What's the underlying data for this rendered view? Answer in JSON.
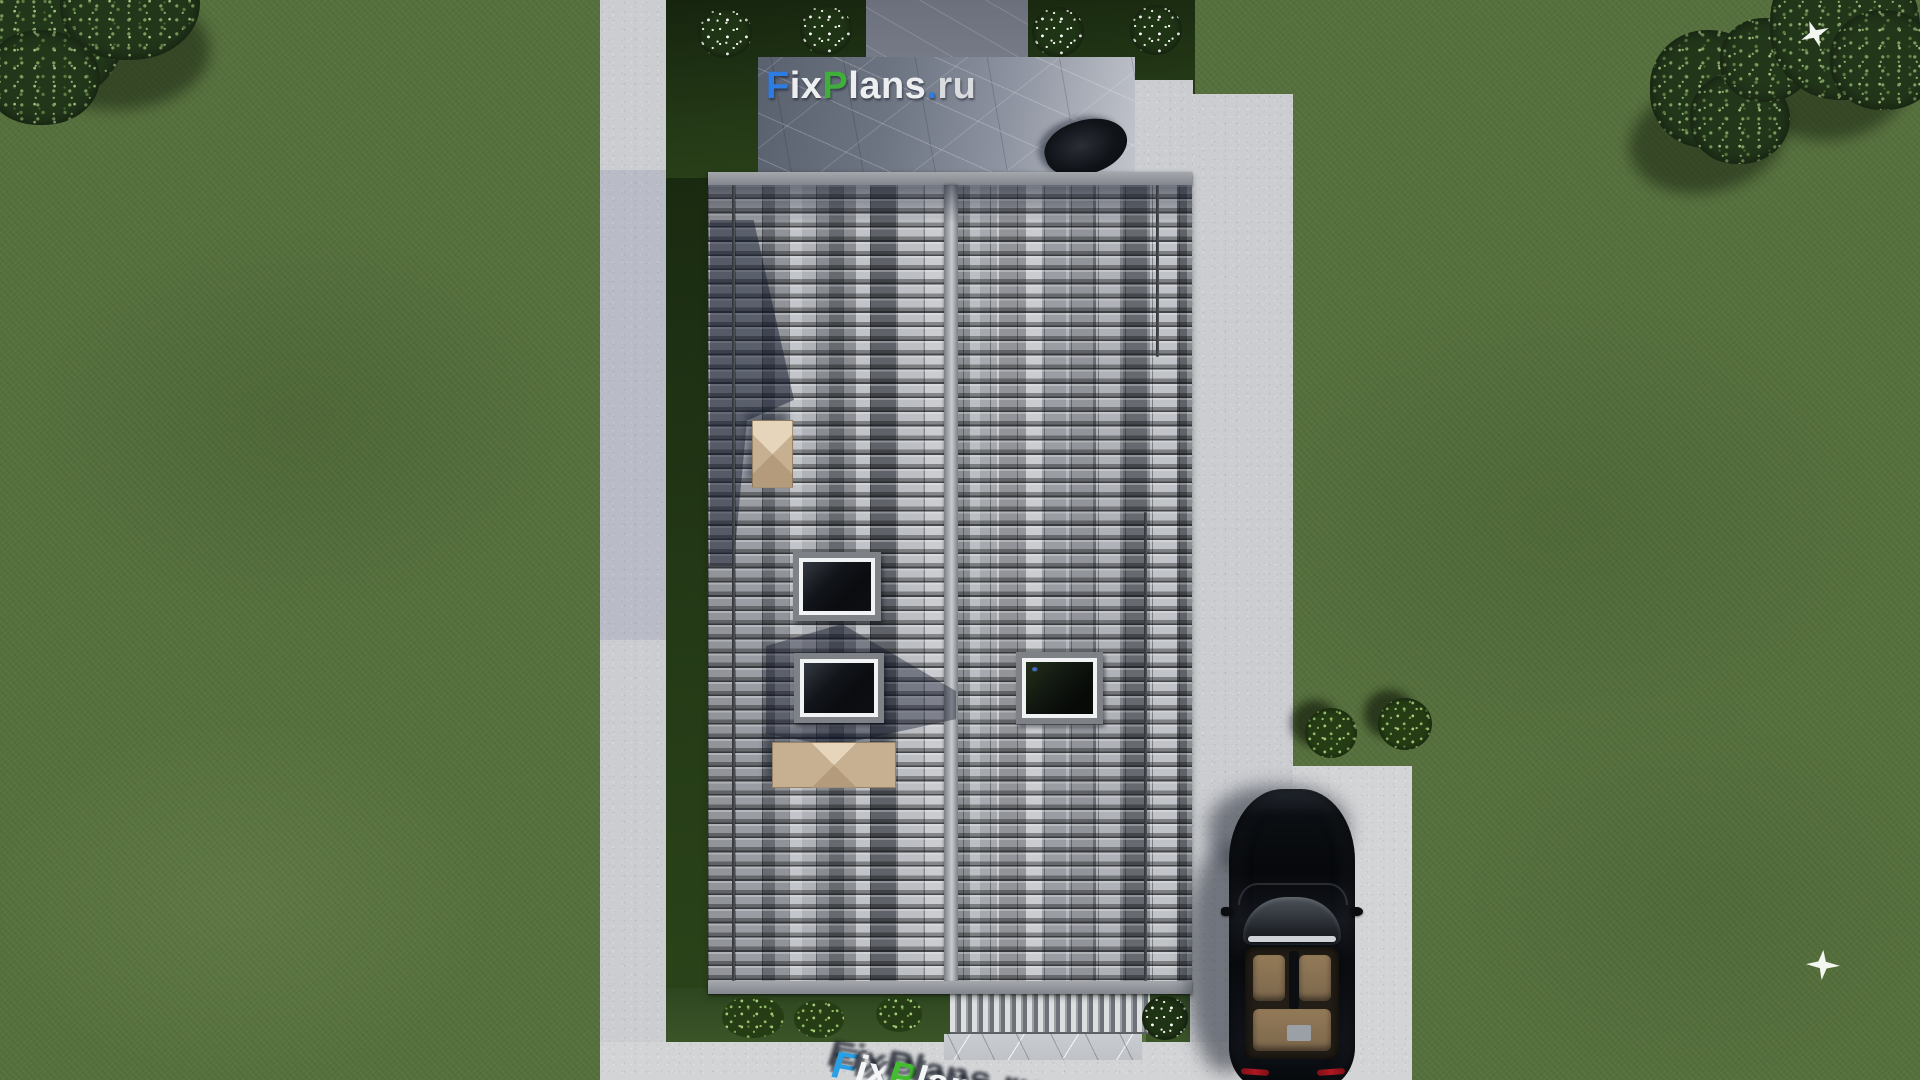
{
  "scene": {
    "kind": "top-down 3D architectural render of a dual-pitch tiled roof house with lawn, paths, patio and driveway"
  },
  "watermark": {
    "full_text": "FixPlans.ru",
    "position": "patio, upper center",
    "segments": [
      {
        "text": "F",
        "color": "#2d7ce2"
      },
      {
        "text": "ix",
        "color": "#eceef0"
      },
      {
        "text": "P",
        "color": "#3fae3a"
      },
      {
        "text": "lans",
        "color": "#eceef0"
      },
      {
        "text": ".",
        "color": "#2d7ce2"
      },
      {
        "text": "ru",
        "color": "#d9dbde"
      }
    ]
  },
  "ground_watermark": {
    "full_text": "FixPlans.ru",
    "style": "3D extruded letters lying on pavement, clipped by bottom edge",
    "segments": [
      {
        "text": "F",
        "color": "#29a0e6"
      },
      {
        "text": "ix",
        "color": "#f4f5f6"
      },
      {
        "text": "P",
        "color": "#43bd30"
      },
      {
        "text": "lans",
        "color": "#f4f5f6"
      },
      {
        "text": ".",
        "color": "#29a0e6"
      },
      {
        "text": "ru",
        "color": "#f4f5f6"
      }
    ]
  },
  "house": {
    "roof": {
      "tile_colors": [
        "#c4c7cb",
        "#8e9298",
        "#5a5e64",
        "#383c42"
      ],
      "ridge_color": "#b9bcc0",
      "skylight_count": 3,
      "chimney_count": 2,
      "chimney_color": "#cdb89a",
      "pergola_stripe_colors": [
        "#dcdee0",
        "#6e7278"
      ]
    },
    "patio_color": "#8d93a0"
  },
  "environment": {
    "grass_color": "#57713e",
    "shadow_bed_color": "#243a17",
    "path_color": "#cbcdd1",
    "driveway_color": "#d3d4d6",
    "tree_count": 3,
    "white_flower_bush_count": 5,
    "green_bush_count": 5,
    "bird_count": 2
  },
  "car": {
    "type": "black convertible seen from above, parked on driveway",
    "body_color": "#0a0d12",
    "interior_color": "#7c674c",
    "taillight_color": "#b01820"
  }
}
